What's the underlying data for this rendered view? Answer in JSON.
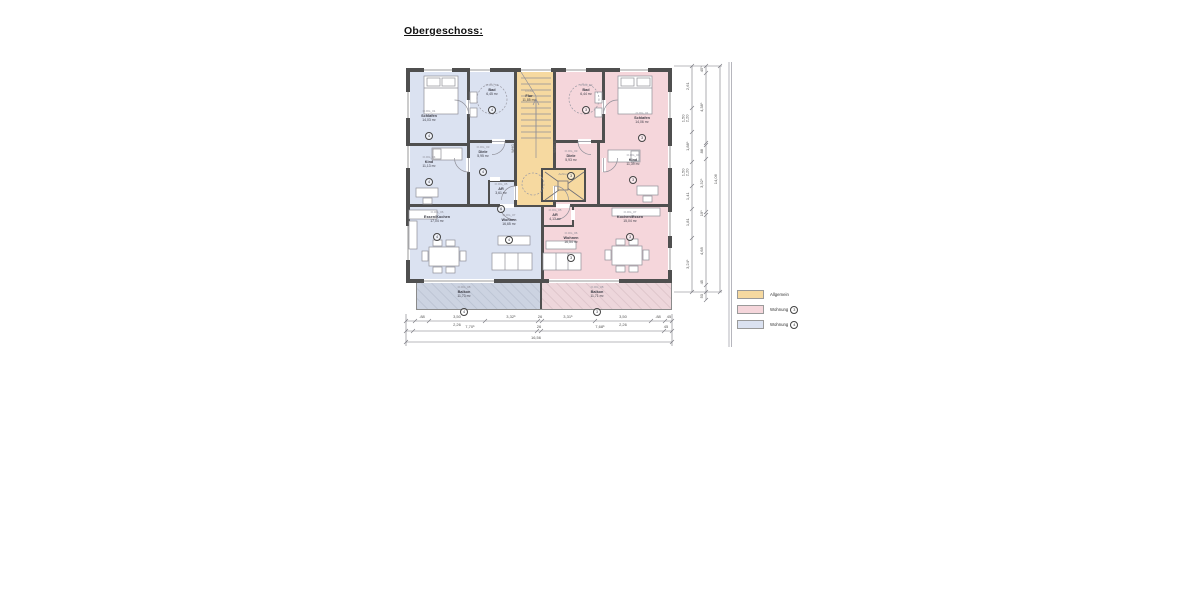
{
  "title": "Obergeschoss:",
  "colors": {
    "wall": "#4F4F4F",
    "allgemein": "#F6D9A0",
    "wohnung3": "#F5D6DB",
    "wohnung4": "#DBE2F1",
    "balkon_w4": "#CCD3E1",
    "balkon_w3": "#EDD6DB"
  },
  "plan": {
    "whg_left_label": "WHG 4",
    "whg_right_label": "WHG 3",
    "allgemein": {
      "flur": {
        "id": "O.OG",
        "name": "Flur",
        "area": "11,85 m²"
      },
      "aufzug": {
        "name": "Aufzug"
      }
    },
    "whg4": {
      "schlafen": {
        "id": "O.OG_01",
        "name": "Schlafen",
        "area": "14,03 m²",
        "apt": "4"
      },
      "bad": {
        "id": "O.OG_02",
        "name": "Bad",
        "area": "6,45 m²",
        "apt": "4"
      },
      "diele": {
        "id": "O.OG_03",
        "name": "Diele",
        "area": "5,95 m²",
        "apt": "4"
      },
      "kind": {
        "id": "O.OG_04",
        "name": "Kind",
        "area": "11,13 m²",
        "apt": "4"
      },
      "ar": {
        "id": "O.OG_05",
        "name": "AR",
        "area": "3,61 m²",
        "apt": "4"
      },
      "essen": {
        "id": "O.OG_06",
        "name": "Essen/Kochen",
        "area": "17,04 m²",
        "apt": "4"
      },
      "wohnen": {
        "id": "O.OG_07",
        "name": "Wohnen",
        "area": "16,65 m²",
        "apt": "4"
      },
      "balkon": {
        "id": "O.OG_08",
        "name": "Balkon",
        "area": "11,73 m²",
        "apt": "4"
      }
    },
    "whg3": {
      "bad": {
        "id": "O.OG_02",
        "name": "Bad",
        "area": "6,44 m²",
        "apt": "3"
      },
      "schlafen": {
        "id": "O.OG_01",
        "name": "Schlafen",
        "area": "14,06 m²",
        "apt": "3"
      },
      "diele": {
        "id": "O.OG_03",
        "name": "Diele",
        "area": "5,93 m²",
        "apt": "3"
      },
      "kind": {
        "id": "O.OG_04",
        "name": "Kind",
        "area": "11,39 m²",
        "apt": "3"
      },
      "ar": {
        "id": "O.OG_05",
        "name": "AR",
        "area": "4,13 m²",
        "apt": "3"
      },
      "wohnen": {
        "id": "O.OG_06",
        "name": "Wohnen",
        "area": "16,54 m²",
        "apt": "3"
      },
      "kochen": {
        "id": "O.OG_07",
        "name": "Kochen/Essen",
        "area": "15,04 m²",
        "apt": "3"
      },
      "balkon": {
        "id": "O.OG_08",
        "name": "Balkon",
        "area": "11,71 m²",
        "apt": "3"
      }
    }
  },
  "dims": {
    "bottom1": [
      {
        "a": ".88"
      },
      {
        "a": "3,50",
        "b": "2,26"
      },
      {
        "a": "3,32⁵"
      },
      {
        "a": "26"
      },
      {
        "a": "3,31⁵"
      },
      {
        "a": "3,50",
        "b": "2,26"
      },
      {
        "a": ".88"
      },
      {
        "a": "45"
      }
    ],
    "bottom2": [
      "7,70⁵",
      "26",
      "7,68⁵",
      "45"
    ],
    "bottom3": "16,56",
    "right1": [
      {
        "a": "2,61"
      },
      {
        "a": "1,50",
        "b": "2,20"
      },
      {
        "a": "1,88⁵"
      },
      {
        "a": "1,50",
        "b": "2,20"
      },
      {
        "a": "1,41"
      },
      {
        "a": "1,81"
      },
      {
        "a": "3,24⁵"
      }
    ],
    "right2": [
      "45⁵",
      "4,38⁵",
      "88",
      "3,32⁵",
      "19⁵",
      "4,68",
      "45",
      "50"
    ],
    "right3": "14,06"
  },
  "legend": {
    "items": [
      {
        "label": "Allgemein"
      },
      {
        "label": "Wohnung",
        "num": "3"
      },
      {
        "label": "Wohnung",
        "num": "4"
      }
    ]
  }
}
